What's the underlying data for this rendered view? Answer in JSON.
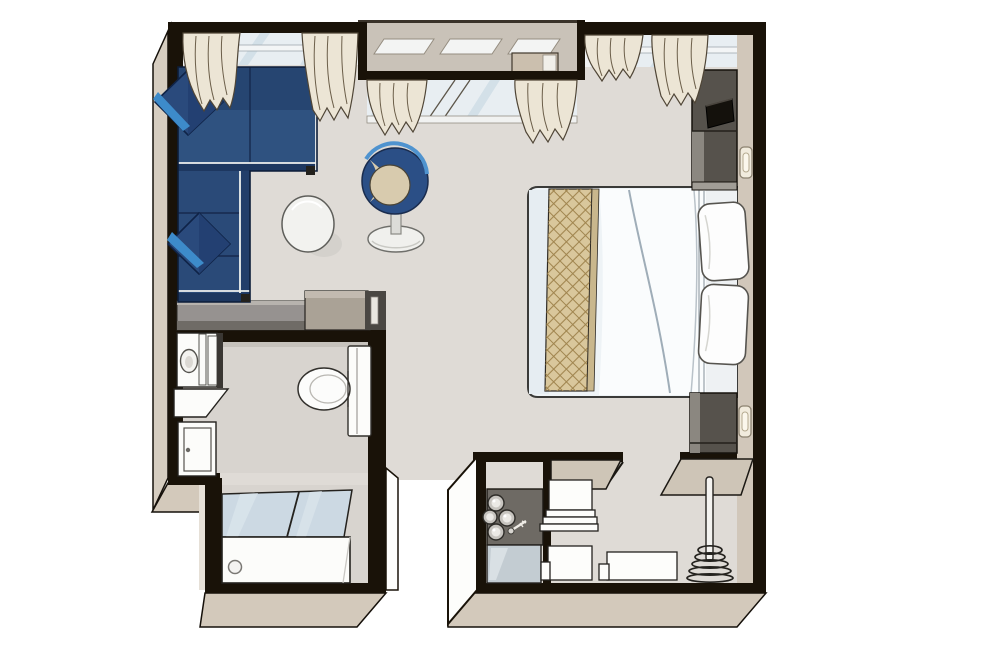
{
  "image": {
    "kind": "isometric-floor-plan",
    "subject": "stateroom-cabin-floor-plan",
    "width_px": 998,
    "height_px": 665,
    "visible_text": []
  },
  "palette": {
    "wall": "#191208",
    "floor": "#dfdbd6",
    "floor_bath": "#d8d4cf",
    "bevel": "#d6cdc0",
    "bevel_dark": "#d3c9bb",
    "wall_face": "#d1c7ba",
    "balcony": "#c9c2b8",
    "glass": "#e8eef2",
    "glass_streak": "#cfdde6",
    "shower_glass": "#ccd9e3",
    "curtain": "#ece5d5",
    "curtain_line": "#6b5e49",
    "sofa": "#2a4a78",
    "sofa_dark": "#1d3760",
    "accent_blue": "#3d8bca",
    "chair_seat": "#d8cbae",
    "runner": "#d9c79c",
    "runner_line": "#a0854f",
    "counter": "#969290",
    "counter_front": "#6f6b66",
    "cabinet": "#56524c",
    "cabinet_light": "#8b8780",
    "shelf_tan": "#cec5b7",
    "fixture": "#fcfcfa",
    "line": "#24221e",
    "minibar": "#6e6a64"
  },
  "furniture": [
    "l-shaped-sofa",
    "throw-pillow",
    "throw-pillow",
    "round-side-table",
    "tub-chair",
    "desk-counter",
    "double-bed",
    "bed-runner",
    "bed-pillow",
    "bed-pillow",
    "tv-cabinet",
    "television",
    "nightstand",
    "wall-switch",
    "wall-switch",
    "window",
    "window",
    "window",
    "curtain",
    "curtain",
    "curtain",
    "curtain",
    "curtain",
    "curtain",
    "balcony-recess",
    "sink-vanity",
    "sink",
    "vanity-shelf",
    "vanity-cabinet",
    "toilet",
    "bathtub",
    "shower-glass-panel",
    "minibar-counter",
    "minibar-bottles",
    "bottle-opener",
    "minibar-glass-front",
    "towel-shelf",
    "towel-shelf",
    "storage-drawer",
    "closet-shelf",
    "closet-shelf",
    "closet-hanging-rod",
    "coat-hangers",
    "entry-wall"
  ]
}
